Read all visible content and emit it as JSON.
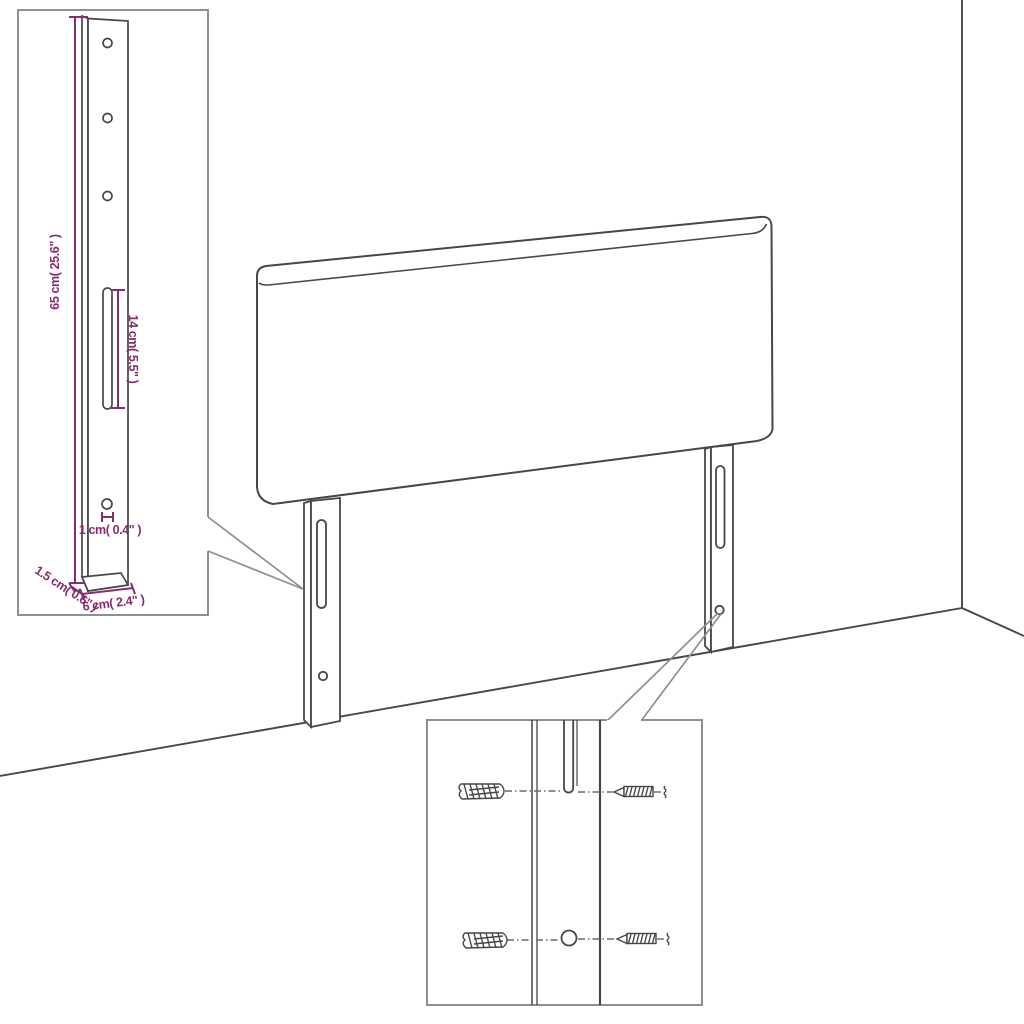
{
  "page": {
    "title": "Headboard assembly dimension diagram",
    "background": "#ffffff"
  },
  "colors": {
    "line": "#474747",
    "thin": "#6a6a6a",
    "callout": "#8f8f8f",
    "dimension": "#862d6f",
    "white": "#ffffff"
  },
  "labels": {
    "leg_height": "65 cm( 25.6\" )",
    "slot_length": "14 cm( 5.5\" )",
    "hole_size": "1 cm( 0.4\" )",
    "leg_thickness": "1.5 cm( 0.6\" )",
    "leg_width": "6 cm( 2.4\" )"
  },
  "parts": {
    "scene": [
      "wall-corner",
      "floor-edge-left",
      "floor-edge-right",
      "headboard-panel",
      "left-mounting-leg",
      "right-mounting-leg"
    ],
    "leg_features": [
      "screw-hole-top",
      "screw-hole-middle",
      "screw-hole-bottom",
      "adjustment-slot",
      "anchor-hole"
    ],
    "inset_leg_detail": [
      "enlarged-mounting-leg",
      "height-dimension",
      "slot-dimension",
      "hole-dimension",
      "thickness-dimension",
      "width-dimension"
    ],
    "inset_mounting_detail": [
      "wall-anchor-upper",
      "wall-anchor-lower",
      "screw-upper",
      "screw-lower",
      "leg-slot",
      "leg-hole",
      "alignment-dash-lines"
    ]
  }
}
